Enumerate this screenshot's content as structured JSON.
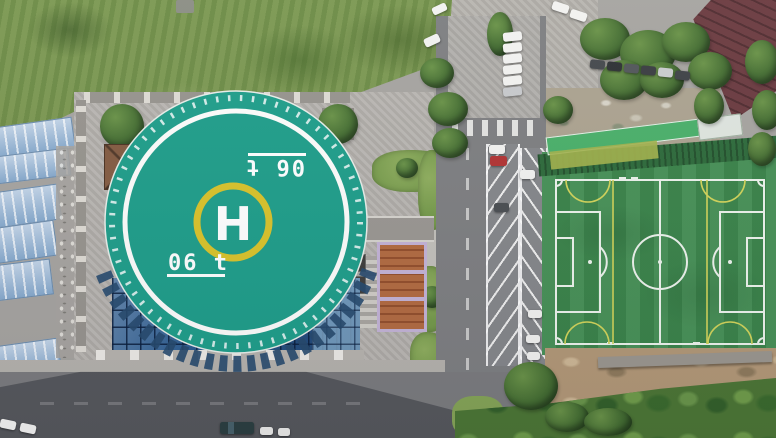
{
  "scene": {
    "description": "Aerial drone photograph: building rooftop with circular helipad over a blue glass atrium, grass lot and blue warehouse roofs on the left, tree-lined car park above, angled parking bays along a road in the middle, and an artificial-turf soccer pitch on the right.",
    "helipad": {
      "center_letter": "H",
      "weight_marking": "06 t",
      "marking_repeated_rotated_180": true,
      "pad_color": "#1f9e8a",
      "inner_ring_color": "#ffffff",
      "h_ring_color": "#d9c32b",
      "letter_color": "#ffffff",
      "edge_tick_color": "#ffffff"
    },
    "soccer_field": {
      "turf_color": "#3e8b4e",
      "line_color": "#edf3ec",
      "secondary_line_color": "#d2d45a",
      "layout": "full pitch with goals left and right, yellow third-lines and arcs overlaid"
    },
    "parking": {
      "bay_stripe_color": "#f5f5f2",
      "bay_rows": 2,
      "crosswalk": true
    },
    "vehicles": {
      "colors": [
        "white",
        "silver",
        "dark-grey",
        "red",
        "black"
      ]
    },
    "colors": {
      "pavement": "#b6b3ae",
      "asphalt": "#7b7c7e",
      "grass": "#7a9750",
      "glass_roof": "#2a5a8e",
      "shed_roofs": "#a9c2dd",
      "pavilion_roof": "#74503a",
      "maroon_roof": "#6b3b40",
      "dirt": "#b29877",
      "vegetation": "#4c7635",
      "shadow": "rgba(35,38,45,0.42)"
    }
  }
}
